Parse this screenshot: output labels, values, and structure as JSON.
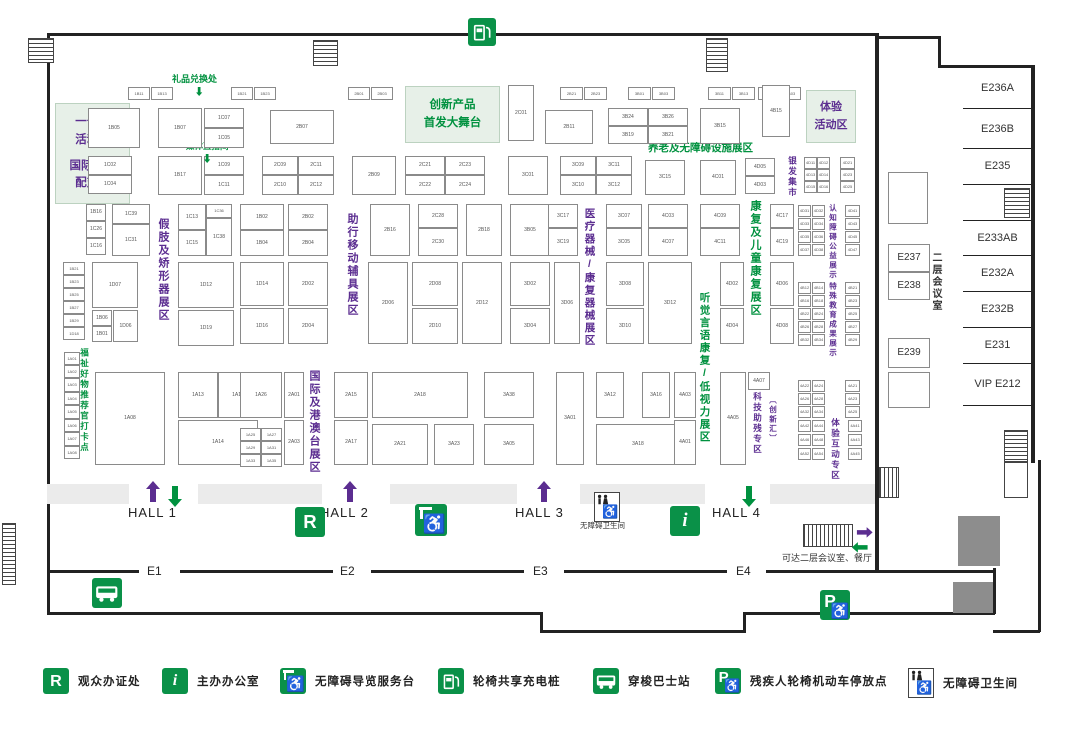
{
  "colors": {
    "green": "#00913f",
    "light_green_bg": "#e7f0e8",
    "purple": "#5b2d90",
    "text_dark": "#333333",
    "booth_text": "#555555"
  },
  "areas": [
    {
      "x": 55,
      "y": 103,
      "w": 73,
      "h": 99,
      "color": "#5b2d90",
      "fs": 11.5,
      "lines": [
        "一号馆",
        "活动区",
        "",
        "国际商贸",
        "配对区"
      ]
    },
    {
      "x": 405,
      "y": 86,
      "w": 93,
      "h": 55,
      "color": "#00913f",
      "fs": 11.5,
      "lines": [
        "创新产品",
        "首发大舞台"
      ]
    },
    {
      "x": 806,
      "y": 90,
      "w": 48,
      "h": 51,
      "color": "#5b2d90",
      "fs": 11,
      "lines": [
        "体验",
        "活动区"
      ]
    }
  ],
  "zone_labels": [
    {
      "x": 157,
      "y": 218,
      "text": "假肢及矫形器展区",
      "color": "#5b2d90",
      "fs": 11
    },
    {
      "x": 346,
      "y": 213,
      "text": "助行移动辅具展区",
      "color": "#5b2d90",
      "fs": 11
    },
    {
      "x": 584,
      "y": 208,
      "text": "医疗器械/康复器械展区",
      "color": "#5b2d90",
      "fs": 10.5
    },
    {
      "x": 308,
      "y": 370,
      "text": "国际及港澳台展区",
      "color": "#5b2d90",
      "fs": 11
    },
    {
      "x": 749,
      "y": 200,
      "text": "康复及儿童康复展区",
      "color": "#00913f",
      "fs": 11
    },
    {
      "x": 699,
      "y": 292,
      "text": "听觉言语康复/低视力展区",
      "color": "#00913f",
      "fs": 10.5
    },
    {
      "x": 788,
      "y": 156,
      "text": "银发集市",
      "color": "#5b2d90",
      "fs": 8.5
    },
    {
      "x": 829,
      "y": 204,
      "text": "认知障碍公益展示",
      "color": "#5b2d90",
      "fs": 7.5
    },
    {
      "x": 829,
      "y": 282,
      "text": "特殊教育成果展示",
      "color": "#5b2d90",
      "fs": 7.5
    },
    {
      "x": 753,
      "y": 392,
      "text": "科技助残专区",
      "color": "#5b2d90",
      "fs": 8.5
    },
    {
      "x": 769,
      "y": 396,
      "text": "〔创新汇〕",
      "color": "#5b2d90",
      "fs": 7.5
    },
    {
      "x": 831,
      "y": 418,
      "text": "体验互动专区",
      "color": "#5b2d90",
      "fs": 8.5
    },
    {
      "x": 80,
      "y": 348,
      "text": "福祉好物推荐官打卡点",
      "color": "#00913f",
      "fs": 8.5
    },
    {
      "x": 930,
      "y": 252,
      "text": "二层会议室",
      "color": "#333333",
      "fs": 10
    }
  ],
  "texts": [
    {
      "x": 172,
      "y": 72,
      "t": "礼品兑换处",
      "c": "#00913f",
      "fs": 9,
      "b": true
    },
    {
      "x": 186,
      "y": 140,
      "t": "媒体直播间",
      "c": "#00913f",
      "fs": 8.5,
      "b": true
    },
    {
      "x": 648,
      "y": 140,
      "t": "养老及无障碍设施展区",
      "c": "#00913f",
      "fs": 10.5,
      "b": true
    },
    {
      "x": 580,
      "y": 520,
      "t": "无障碍卫生间",
      "c": "#333333",
      "fs": 7.5,
      "b": false
    },
    {
      "x": 782,
      "y": 551,
      "t": "可达二层会议室、餐厅",
      "c": "#333333",
      "fs": 9,
      "b": false
    }
  ],
  "halls": [
    {
      "t": "HALL 1",
      "x": 128,
      "y": 505
    },
    {
      "t": "HALL 2",
      "x": 320,
      "y": 505
    },
    {
      "t": "HALL 3",
      "x": 515,
      "y": 505
    },
    {
      "t": "HALL 4",
      "x": 712,
      "y": 505
    }
  ],
  "entrances": [
    {
      "t": "E1",
      "x": 147,
      "y": 564
    },
    {
      "t": "E2",
      "x": 340,
      "y": 564
    },
    {
      "t": "E3",
      "x": 533,
      "y": 564
    },
    {
      "t": "E4",
      "x": 736,
      "y": 564
    }
  ],
  "rooms": {
    "list": [
      {
        "label": "E236A",
        "y": 68,
        "h": 40
      },
      {
        "label": "E236B",
        "y": 110,
        "h": 38
      },
      {
        "label": "E235",
        "y": 148,
        "h": 36
      },
      {
        "label": "",
        "y": 184,
        "h": 36
      },
      {
        "label": "E233AB",
        "y": 220,
        "h": 35
      },
      {
        "label": "E232A",
        "y": 255,
        "h": 36
      },
      {
        "label": "E232B",
        "y": 291,
        "h": 36
      },
      {
        "label": "E231",
        "y": 327,
        "h": 36
      },
      {
        "label": "VIP E212",
        "y": 363,
        "h": 42
      }
    ],
    "boxes": [
      {
        "label": "",
        "x": 888,
        "y": 172,
        "w": 40,
        "h": 52
      },
      {
        "label": "E237",
        "x": 888,
        "y": 244,
        "w": 42,
        "h": 28
      },
      {
        "label": "E238",
        "x": 888,
        "y": 272,
        "w": 42,
        "h": 28
      },
      {
        "label": "E239",
        "x": 888,
        "y": 338,
        "w": 42,
        "h": 30
      },
      {
        "label": "",
        "x": 888,
        "y": 372,
        "w": 42,
        "h": 36
      }
    ]
  },
  "legend": [
    {
      "icon": "rbadge",
      "glyph": "R",
      "label": "观众办证处"
    },
    {
      "icon": "ibadge",
      "glyph": "i",
      "label": "主办办公室"
    },
    {
      "icon": "guide",
      "glyph": "",
      "label": "无障碍导览服务台"
    },
    {
      "icon": "charge",
      "glyph": "",
      "label": "轮椅共享充电桩"
    },
    {
      "icon": "bus",
      "glyph": "",
      "label": "穿梭巴士站"
    },
    {
      "icon": "parking",
      "glyph": "P",
      "label": "残疾人轮椅机动车停放点"
    },
    {
      "icon": "toilet",
      "glyph": "",
      "label": "无障碍卫生间"
    }
  ],
  "map_icons": [
    {
      "icon": "charge",
      "glyph": "",
      "x": 468,
      "y": 18,
      "s": 28,
      "name": "wheelchair-charging-icon"
    },
    {
      "icon": "rbadge",
      "glyph": "R",
      "x": 295,
      "y": 507,
      "s": 30,
      "name": "registration-icon"
    },
    {
      "icon": "guide",
      "glyph": "",
      "x": 415,
      "y": 504,
      "s": 32,
      "name": "accessible-guide-icon"
    },
    {
      "icon": "toilet",
      "glyph": "",
      "x": 594,
      "y": 492,
      "s": 26,
      "name": "accessible-toilet-icon"
    },
    {
      "icon": "ibadge",
      "glyph": "i",
      "x": 670,
      "y": 506,
      "s": 30,
      "name": "info-office-icon"
    },
    {
      "icon": "bus",
      "glyph": "",
      "x": 92,
      "y": 578,
      "s": 30,
      "name": "shuttle-bus-icon"
    },
    {
      "icon": "parking",
      "glyph": "P",
      "x": 820,
      "y": 590,
      "s": 30,
      "name": "accessible-parking-icon"
    }
  ],
  "booths": [
    [
      128,
      87,
      22,
      13,
      "1B11"
    ],
    [
      151,
      87,
      22,
      13,
      "1B13"
    ],
    [
      231,
      87,
      22,
      13,
      "1B21"
    ],
    [
      254,
      87,
      22,
      13,
      "1B23"
    ],
    [
      348,
      87,
      22,
      13,
      "2B01"
    ],
    [
      371,
      87,
      22,
      13,
      "2B03"
    ],
    [
      560,
      87,
      23,
      13,
      "2B21"
    ],
    [
      584,
      87,
      23,
      13,
      "2B23"
    ],
    [
      628,
      87,
      23,
      13,
      "3B01"
    ],
    [
      652,
      87,
      23,
      13,
      "3B03"
    ],
    [
      708,
      87,
      23,
      13,
      "3B11"
    ],
    [
      732,
      87,
      23,
      13,
      "3B13"
    ],
    [
      758,
      87,
      21,
      13,
      "4B01"
    ],
    [
      780,
      87,
      21,
      13,
      "4B03"
    ],
    [
      88,
      108,
      52,
      40,
      "1B05"
    ],
    [
      158,
      108,
      44,
      40,
      "1B07"
    ],
    [
      204,
      108,
      40,
      20,
      "1C07"
    ],
    [
      204,
      128,
      40,
      20,
      "1C05"
    ],
    [
      270,
      110,
      64,
      34,
      "2B07"
    ],
    [
      508,
      85,
      26,
      56,
      "2C01"
    ],
    [
      545,
      110,
      48,
      34,
      "2B11"
    ],
    [
      608,
      108,
      40,
      18,
      "3B24"
    ],
    [
      648,
      108,
      40,
      18,
      "3B26"
    ],
    [
      608,
      126,
      40,
      18,
      "3B19"
    ],
    [
      648,
      126,
      40,
      18,
      "3B21"
    ],
    [
      700,
      108,
      40,
      36,
      "3B15"
    ],
    [
      762,
      85,
      28,
      52,
      "4B15"
    ],
    [
      88,
      156,
      44,
      19,
      "1C02"
    ],
    [
      88,
      175,
      44,
      19,
      "1C04"
    ],
    [
      158,
      156,
      44,
      39,
      "1B17"
    ],
    [
      204,
      156,
      40,
      19,
      "1C09"
    ],
    [
      204,
      175,
      40,
      20,
      "1C11"
    ],
    [
      262,
      156,
      36,
      19,
      "2C09"
    ],
    [
      298,
      156,
      36,
      19,
      "2C11"
    ],
    [
      262,
      175,
      36,
      20,
      "2C10"
    ],
    [
      298,
      175,
      36,
      20,
      "2C12"
    ],
    [
      352,
      156,
      44,
      39,
      "2B09"
    ],
    [
      405,
      156,
      40,
      19,
      "2C21"
    ],
    [
      445,
      156,
      40,
      19,
      "2C23"
    ],
    [
      405,
      175,
      40,
      20,
      "2C22"
    ],
    [
      445,
      175,
      40,
      20,
      "2C24"
    ],
    [
      508,
      156,
      40,
      39,
      "3C01"
    ],
    [
      560,
      156,
      36,
      19,
      "3C09"
    ],
    [
      596,
      156,
      36,
      19,
      "3C11"
    ],
    [
      560,
      175,
      36,
      20,
      "3C10"
    ],
    [
      596,
      175,
      36,
      20,
      "3C12"
    ],
    [
      645,
      160,
      40,
      35,
      "3C15"
    ],
    [
      700,
      160,
      36,
      35,
      "4C01"
    ],
    [
      745,
      158,
      30,
      18,
      "4D05"
    ],
    [
      745,
      176,
      30,
      18,
      "4D03"
    ],
    [
      804,
      157,
      13,
      12,
      "4D11"
    ],
    [
      817,
      157,
      13,
      12,
      "4D12"
    ],
    [
      804,
      169,
      13,
      12,
      "4D13"
    ],
    [
      817,
      169,
      13,
      12,
      "4D14"
    ],
    [
      804,
      181,
      13,
      12,
      "4D15"
    ],
    [
      817,
      181,
      13,
      12,
      "4D16"
    ],
    [
      840,
      157,
      15,
      12,
      "4D21"
    ],
    [
      840,
      169,
      15,
      12,
      "4D23"
    ],
    [
      840,
      181,
      15,
      12,
      "4D25"
    ],
    [
      86,
      204,
      20,
      17,
      "1B16"
    ],
    [
      86,
      221,
      20,
      17,
      "1C26"
    ],
    [
      86,
      238,
      20,
      17,
      "1C16"
    ],
    [
      112,
      204,
      38,
      20,
      "1C39"
    ],
    [
      112,
      224,
      38,
      32,
      "1C31"
    ],
    [
      178,
      204,
      28,
      26,
      "1C13"
    ],
    [
      206,
      204,
      26,
      14,
      "1C36"
    ],
    [
      206,
      218,
      26,
      38,
      "1C38"
    ],
    [
      178,
      230,
      28,
      26,
      "1C15"
    ],
    [
      240,
      204,
      44,
      26,
      "1B02"
    ],
    [
      240,
      230,
      44,
      26,
      "1B04"
    ],
    [
      288,
      204,
      40,
      26,
      "2B02"
    ],
    [
      288,
      230,
      40,
      26,
      "2B04"
    ],
    [
      370,
      204,
      40,
      52,
      "2B16"
    ],
    [
      418,
      204,
      40,
      24,
      "2C28"
    ],
    [
      418,
      228,
      40,
      28,
      "2C30"
    ],
    [
      466,
      204,
      36,
      52,
      "2B18"
    ],
    [
      510,
      204,
      40,
      52,
      "3B05"
    ],
    [
      548,
      204,
      30,
      24,
      "3C17"
    ],
    [
      548,
      228,
      30,
      28,
      "3C19"
    ],
    [
      606,
      204,
      36,
      24,
      "3C07"
    ],
    [
      606,
      228,
      36,
      28,
      "3C05"
    ],
    [
      648,
      204,
      40,
      24,
      "4C03"
    ],
    [
      648,
      228,
      40,
      28,
      "4C07"
    ],
    [
      700,
      204,
      40,
      24,
      "4C09"
    ],
    [
      700,
      228,
      40,
      28,
      "4C11"
    ],
    [
      770,
      204,
      24,
      24,
      "4C17"
    ],
    [
      770,
      228,
      24,
      28,
      "4C19"
    ],
    [
      798,
      205,
      13,
      12,
      "4D31"
    ],
    [
      812,
      205,
      13,
      12,
      "4D32"
    ],
    [
      798,
      218,
      13,
      12,
      "4D33"
    ],
    [
      812,
      218,
      13,
      12,
      "4D34"
    ],
    [
      798,
      231,
      13,
      12,
      "4D35"
    ],
    [
      812,
      231,
      13,
      12,
      "4D36"
    ],
    [
      798,
      244,
      13,
      12,
      "4D37"
    ],
    [
      812,
      244,
      13,
      12,
      "4D38"
    ],
    [
      845,
      205,
      15,
      12,
      "4D41"
    ],
    [
      845,
      218,
      15,
      12,
      "4D43"
    ],
    [
      845,
      231,
      15,
      12,
      "4D45"
    ],
    [
      845,
      244,
      15,
      12,
      "4D47"
    ],
    [
      63,
      262,
      22,
      13,
      "1B21"
    ],
    [
      63,
      275,
      22,
      13,
      "1B23"
    ],
    [
      63,
      288,
      22,
      13,
      "1B25"
    ],
    [
      63,
      301,
      22,
      13,
      "1B27"
    ],
    [
      63,
      314,
      22,
      13,
      "1B29"
    ],
    [
      63,
      327,
      22,
      13,
      "1D18"
    ],
    [
      92,
      262,
      46,
      46,
      "1D07"
    ],
    [
      92,
      310,
      20,
      16,
      "1B06"
    ],
    [
      92,
      326,
      20,
      16,
      "1B01"
    ],
    [
      113,
      310,
      25,
      32,
      "1D06"
    ],
    [
      178,
      262,
      56,
      46,
      "1D12"
    ],
    [
      178,
      310,
      56,
      36,
      "1D19"
    ],
    [
      240,
      262,
      44,
      44,
      "1D14"
    ],
    [
      240,
      308,
      44,
      36,
      "1D16"
    ],
    [
      288,
      262,
      40,
      44,
      "2D02"
    ],
    [
      288,
      308,
      40,
      36,
      "2D04"
    ],
    [
      368,
      262,
      40,
      82,
      "2D06"
    ],
    [
      412,
      262,
      46,
      44,
      "2D08"
    ],
    [
      412,
      308,
      46,
      36,
      "2D10"
    ],
    [
      462,
      262,
      40,
      82,
      "2D12"
    ],
    [
      510,
      262,
      40,
      44,
      "3D02"
    ],
    [
      510,
      308,
      40,
      36,
      "3D04"
    ],
    [
      554,
      262,
      26,
      82,
      "3D06"
    ],
    [
      606,
      262,
      38,
      44,
      "3D08"
    ],
    [
      606,
      308,
      38,
      36,
      "3D10"
    ],
    [
      648,
      262,
      44,
      82,
      "3D12"
    ],
    [
      720,
      262,
      24,
      44,
      "4D02"
    ],
    [
      720,
      308,
      24,
      36,
      "4D04"
    ],
    [
      770,
      262,
      24,
      44,
      "4D06"
    ],
    [
      770,
      308,
      24,
      36,
      "4D08"
    ],
    [
      798,
      282,
      13,
      12,
      "4B12"
    ],
    [
      812,
      282,
      13,
      12,
      "4B14"
    ],
    [
      798,
      295,
      13,
      12,
      "4B16"
    ],
    [
      812,
      295,
      13,
      12,
      "4B18"
    ],
    [
      798,
      308,
      13,
      12,
      "4B22"
    ],
    [
      812,
      308,
      13,
      12,
      "4B24"
    ],
    [
      798,
      321,
      13,
      12,
      "4B26"
    ],
    [
      812,
      321,
      13,
      12,
      "4B28"
    ],
    [
      798,
      334,
      13,
      12,
      "4B32"
    ],
    [
      812,
      334,
      13,
      12,
      "4B34"
    ],
    [
      845,
      282,
      15,
      12,
      "4B21"
    ],
    [
      845,
      295,
      15,
      12,
      "4B23"
    ],
    [
      845,
      308,
      15,
      12,
      "4B25"
    ],
    [
      845,
      321,
      15,
      12,
      "4B27"
    ],
    [
      845,
      334,
      15,
      12,
      "4B29"
    ],
    [
      64,
      352,
      16,
      13,
      "1A01"
    ],
    [
      64,
      365,
      16,
      13,
      "1A02"
    ],
    [
      64,
      378,
      16,
      14,
      "1A03"
    ],
    [
      64,
      392,
      16,
      13,
      "1A04"
    ],
    [
      64,
      405,
      16,
      14,
      "1A05"
    ],
    [
      64,
      419,
      16,
      13,
      "1A06"
    ],
    [
      64,
      432,
      16,
      14,
      "1A07"
    ],
    [
      64,
      446,
      16,
      13,
      "1A08"
    ],
    [
      95,
      372,
      70,
      93,
      "1A08"
    ],
    [
      178,
      372,
      40,
      46,
      "1A13"
    ],
    [
      218,
      372,
      40,
      46,
      "1A15"
    ],
    [
      178,
      420,
      80,
      45,
      "1A14"
    ],
    [
      240,
      372,
      42,
      46,
      "1A26"
    ],
    [
      240,
      428,
      21,
      13,
      "1A25"
    ],
    [
      261,
      428,
      21,
      13,
      "1A27"
    ],
    [
      240,
      441,
      21,
      13,
      "1A29"
    ],
    [
      261,
      441,
      21,
      13,
      "1A31"
    ],
    [
      240,
      454,
      21,
      13,
      "1A33"
    ],
    [
      261,
      454,
      21,
      13,
      "1A35"
    ],
    [
      284,
      372,
      20,
      46,
      "2A01"
    ],
    [
      284,
      420,
      20,
      45,
      "2A03"
    ],
    [
      334,
      372,
      34,
      46,
      "2A15"
    ],
    [
      334,
      420,
      34,
      45,
      "2A17"
    ],
    [
      372,
      372,
      96,
      46,
      "2A18"
    ],
    [
      372,
      424,
      56,
      41,
      "2A21"
    ],
    [
      434,
      424,
      40,
      41,
      "3A23"
    ],
    [
      484,
      372,
      50,
      46,
      "3A38"
    ],
    [
      484,
      424,
      50,
      41,
      "3A05"
    ],
    [
      556,
      372,
      28,
      93,
      "3A01"
    ],
    [
      596,
      372,
      28,
      46,
      "3A12"
    ],
    [
      642,
      372,
      28,
      46,
      "3A16"
    ],
    [
      596,
      424,
      84,
      41,
      "3A18"
    ],
    [
      674,
      372,
      22,
      46,
      "4A03"
    ],
    [
      674,
      420,
      22,
      45,
      "4A01"
    ],
    [
      720,
      372,
      26,
      93,
      "4A05"
    ],
    [
      748,
      372,
      22,
      18,
      "4A07"
    ],
    [
      798,
      380,
      13,
      12,
      "4A22"
    ],
    [
      812,
      380,
      13,
      12,
      "4A24"
    ],
    [
      798,
      393,
      13,
      12,
      "4A26"
    ],
    [
      812,
      393,
      13,
      12,
      "4A28"
    ],
    [
      798,
      406,
      13,
      12,
      "4A32"
    ],
    [
      812,
      406,
      13,
      12,
      "4A34"
    ],
    [
      845,
      380,
      15,
      12,
      "4A21"
    ],
    [
      845,
      393,
      15,
      12,
      "4A23"
    ],
    [
      845,
      406,
      15,
      12,
      "4A25"
    ],
    [
      798,
      420,
      13,
      12,
      "4A42"
    ],
    [
      812,
      420,
      13,
      12,
      "4A44"
    ],
    [
      798,
      434,
      13,
      12,
      "4A46"
    ],
    [
      812,
      434,
      13,
      12,
      "4A48"
    ],
    [
      798,
      448,
      13,
      12,
      "4A52"
    ],
    [
      812,
      448,
      13,
      12,
      "4A54"
    ],
    [
      848,
      420,
      14,
      12,
      "4A41"
    ],
    [
      848,
      434,
      14,
      12,
      "4A43"
    ],
    [
      848,
      448,
      14,
      12,
      "4A45"
    ]
  ]
}
